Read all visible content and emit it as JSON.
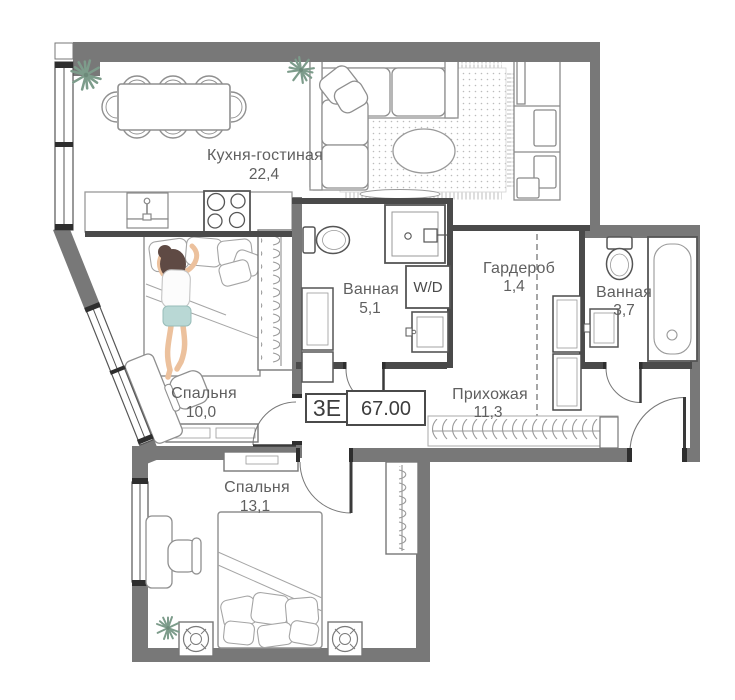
{
  "plan": {
    "badge": {
      "layout_type": "3Е",
      "total_area": "67.00"
    },
    "rooms": {
      "kitchen": {
        "name": "Кухня-гостиная",
        "area": "22,4"
      },
      "bedroom_small": {
        "name": "Спальня",
        "area": "10,0"
      },
      "bedroom_large": {
        "name": "Спальня",
        "area": "13,1"
      },
      "bathroom_main": {
        "name": "Ванная",
        "area": "5,1"
      },
      "bathroom_second": {
        "name": "Ванная",
        "area": "3,7"
      },
      "wardrobe": {
        "name": "Гардероб",
        "area": "1,4"
      },
      "hallway": {
        "name": "Прихожая",
        "area": "11,3"
      }
    },
    "labels": {
      "washer_dryer": "W/D"
    },
    "furniture": {
      "kitchen_living": [
        "dining-table-8-chairs",
        "corner-sofa",
        "rug",
        "coffee-table",
        "tv-unit",
        "kitchen-sink",
        "stove",
        "plants"
      ],
      "bedroom_small": [
        "double-bed",
        "person-sleeping",
        "wardrobe-hangers",
        "desk",
        "chair",
        "dresser"
      ],
      "bedroom_large": [
        "double-bed",
        "nightstands-with-lamps",
        "wardrobe-hangers",
        "desk",
        "chair",
        "tv-stand",
        "plant"
      ],
      "bathroom_main": [
        "toilet",
        "shower",
        "washer-dryer",
        "sink",
        "cabinet"
      ],
      "bathroom_second": [
        "toilet",
        "bathtub",
        "sink"
      ],
      "hallway": [
        "coat-rack",
        "entrance-door",
        "cabinet"
      ]
    },
    "colors": {
      "wall": "#787878",
      "partition": "#4a4a4a",
      "furniture_stroke": "#8f8f8f",
      "fixture_stroke": "#555555",
      "plant": "#7d9c8b",
      "text": "#5f5f5f",
      "hair": "#5f4a44",
      "skin": "#ecc19d",
      "shorts": "#b9d8d5"
    }
  }
}
